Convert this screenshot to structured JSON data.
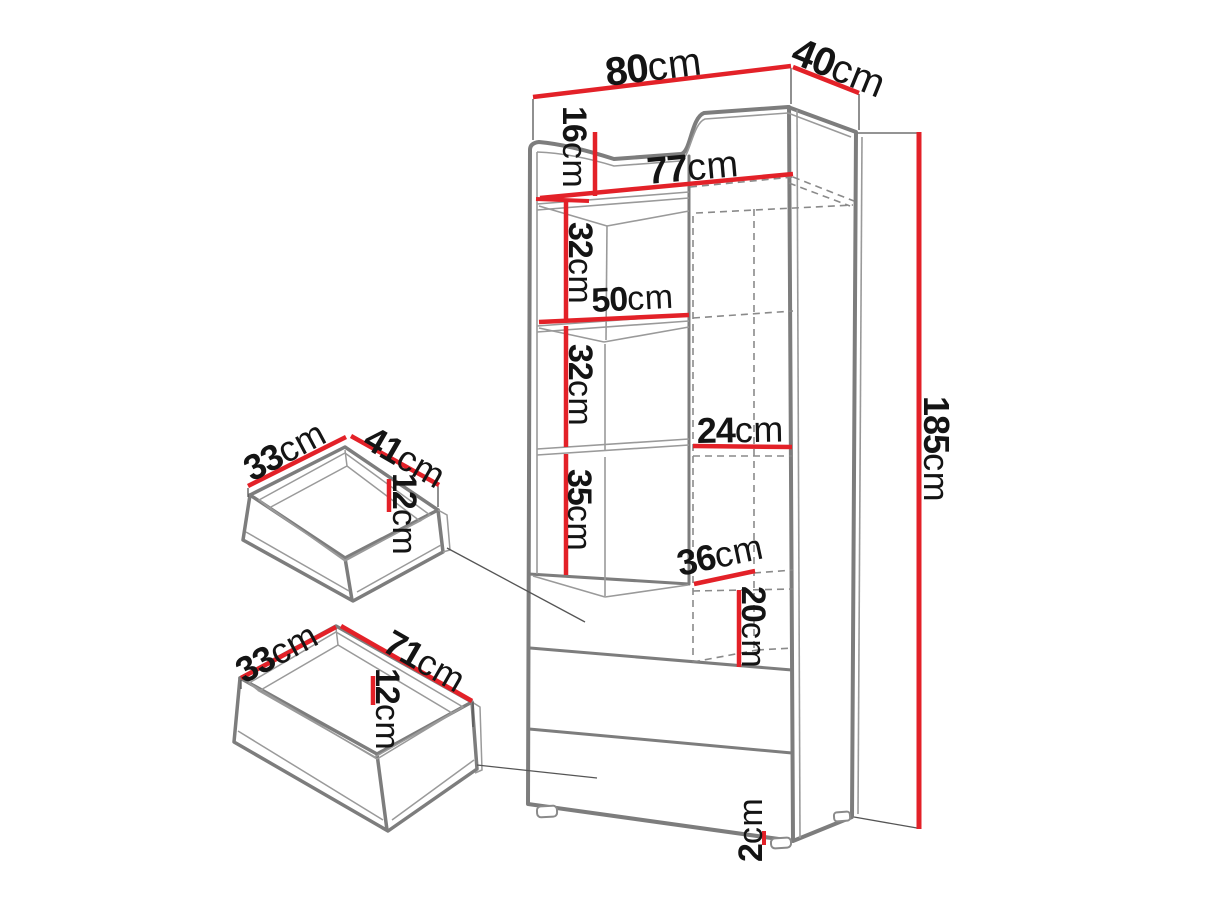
{
  "diagram": {
    "kind": "furniture-dimension-drawing",
    "unit": "cm"
  },
  "colors": {
    "dimension": "#e32128",
    "outline": "#7d7d7d",
    "thin": "#9a9a9a",
    "dashed": "#8a8a8a",
    "extension": "#555555",
    "text": "#141414",
    "background": "#ffffff"
  },
  "cabinet": {
    "width": {
      "value": "80",
      "unit": "cm"
    },
    "depth": {
      "value": "40",
      "unit": "cm"
    },
    "height": {
      "value": "185",
      "unit": "cm"
    },
    "top_offset": {
      "value": "16",
      "unit": "cm"
    },
    "interior_width": {
      "value": "77",
      "unit": "cm"
    },
    "shelf_gap_1": {
      "value": "32",
      "unit": "cm"
    },
    "left_section_width": {
      "value": "50",
      "unit": "cm"
    },
    "shelf_gap_2": {
      "value": "32",
      "unit": "cm"
    },
    "shelf_gap_3": {
      "value": "35",
      "unit": "cm"
    },
    "niche_width": {
      "value": "24",
      "unit": "cm"
    },
    "niche_depth": {
      "value": "36",
      "unit": "cm"
    },
    "niche_height": {
      "value": "20",
      "unit": "cm"
    },
    "feet_height": {
      "value": "2",
      "unit": "cm"
    }
  },
  "drawer_small": {
    "width": {
      "value": "33",
      "unit": "cm"
    },
    "depth": {
      "value": "41",
      "unit": "cm"
    },
    "height": {
      "value": "12",
      "unit": "cm"
    }
  },
  "drawer_large": {
    "width": {
      "value": "33",
      "unit": "cm"
    },
    "depth": {
      "value": "71",
      "unit": "cm"
    },
    "height": {
      "value": "12",
      "unit": "cm"
    }
  }
}
